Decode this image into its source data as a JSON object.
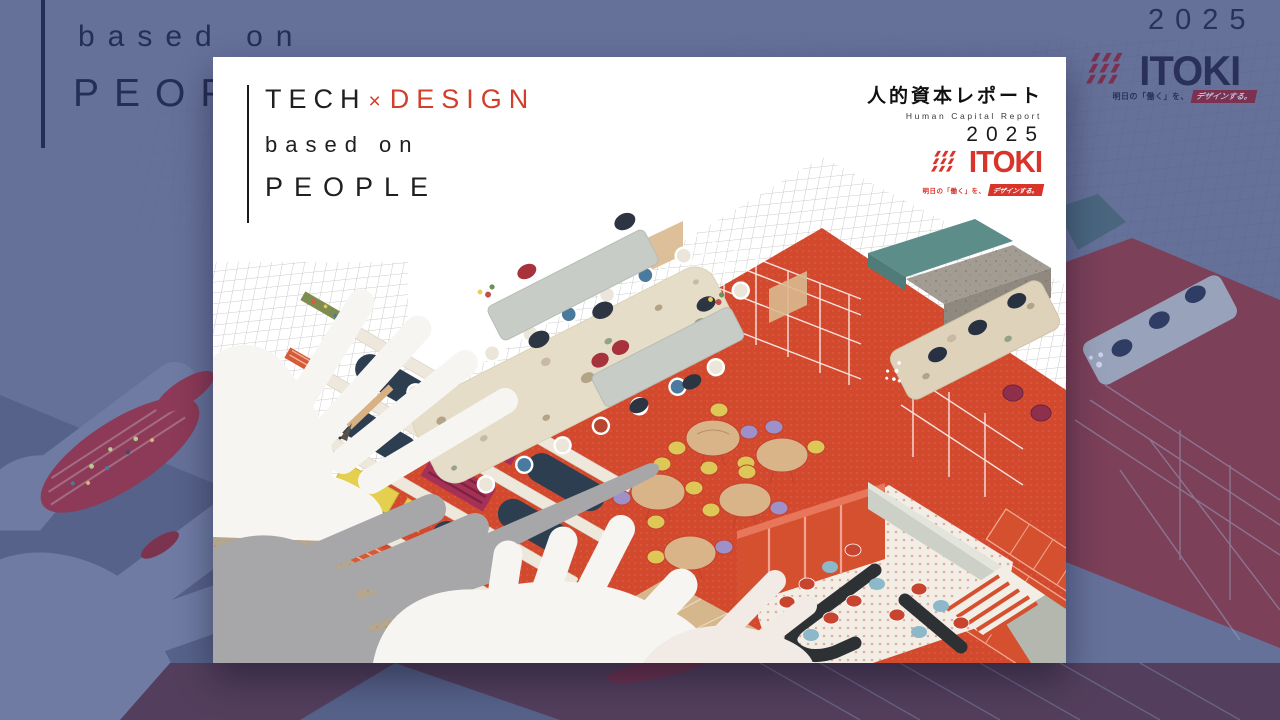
{
  "backdrop": {
    "tagline_line1": "based on",
    "tagline_line2": "PEOPLE",
    "year": "2025",
    "brand": "ITOKI",
    "brand_tagline_prefix": "明日の「働く」を、",
    "brand_tagline_highlight": "デザインする。",
    "colors": {
      "base": "#66719a",
      "shape_dark": "#57628a",
      "shape_light": "#6f7ba3",
      "maroon": "#8c3a57",
      "bottom_band": "#533f5d",
      "ink": "#252e56"
    }
  },
  "cover": {
    "headline": {
      "part1": "TECH",
      "times": "×",
      "part2": "DESIGN",
      "line2": "based on",
      "line3": "PEOPLE"
    },
    "report": {
      "title_jp": "人的資本レポート",
      "title_en": "Human Capital Report",
      "year": "2025"
    },
    "brand": {
      "name": "ITOKI",
      "tagline_prefix": "明日の「働く」を、",
      "tagline_highlight": "デザインする。"
    },
    "palette": {
      "accent_red": "#d8342a",
      "floor_red": "#d2492e",
      "teal": "#5d8d89",
      "navy_sofa": "#2c3e50",
      "crimson": "#a53157",
      "yellow": "#e4cf4f",
      "wood": "#d8b488",
      "beige": "#e6ddc8",
      "gray_table": "#c8ccc6",
      "purple_chair": "#9e90c8",
      "hand_white": "#f7f5f2",
      "hand_gray": "#a7a7a9"
    }
  }
}
